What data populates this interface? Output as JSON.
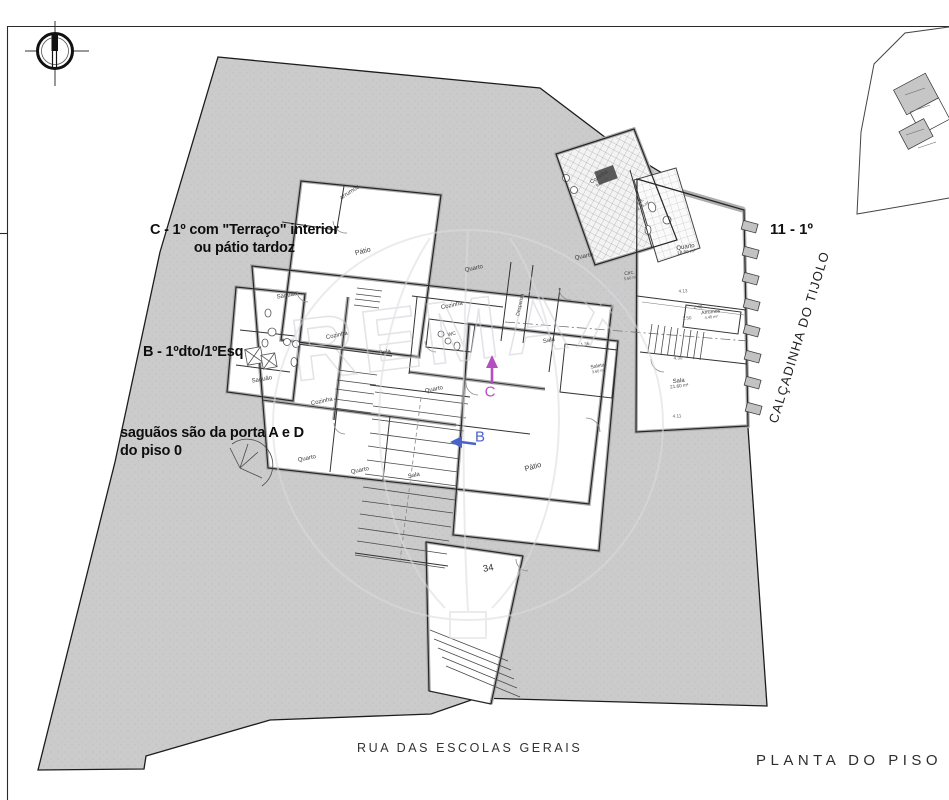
{
  "page": {
    "title": "PLANTA DO PISO 1",
    "street_bottom": "RUA DAS ESCOLAS GERAIS",
    "street_right": "CALÇADINHA DO TIJOLO",
    "unit_note_right": "11 - 1º",
    "house_number": "34"
  },
  "annotations": {
    "unit_c": {
      "line1": "C - 1º com \"Terraço\" interior",
      "line2": "ou pátio tardoz"
    },
    "unit_b": {
      "line1": "B - 1ºdto/1ºEsq"
    },
    "saguaos": {
      "line1": "saguãos são da porta A e D",
      "line2": "do piso 0"
    }
  },
  "markers": {
    "b": "B",
    "c": "C"
  },
  "watermark": {
    "brand": "REMAX"
  },
  "colors": {
    "site_fill": "#cbcbcb",
    "wall_gray": "#aeaeae",
    "ink": "#222222",
    "marker_b_blue": "#4a63c8",
    "marker_c_magenta": "#b44fc0",
    "watermark_gray": "#d6d6da"
  },
  "plan": {
    "rooms": [
      {
        "label": "arrumos",
        "x": 350,
        "y": 193,
        "rot": -33,
        "size": 6
      },
      {
        "label": "Pátio",
        "x": 363,
        "y": 252,
        "rot": -14,
        "size": 7
      },
      {
        "label": "Saguão",
        "x": 287,
        "y": 296,
        "rot": -10,
        "size": 6
      },
      {
        "label": "Cozinha",
        "x": 601,
        "y": 180,
        "rot": -34,
        "size": 5.5,
        "area": "9.60 m²"
      },
      {
        "label": "I.S.",
        "x": 642,
        "y": 204,
        "rot": -34,
        "size": 5,
        "area": "4.15 m²"
      },
      {
        "label": "Quarto",
        "x": 474,
        "y": 269,
        "rot": -12,
        "size": 6
      },
      {
        "label": "Quarto",
        "x": 584,
        "y": 257,
        "rot": -12,
        "size": 6
      },
      {
        "label": "Quarto",
        "x": 686,
        "y": 250,
        "rot": -9,
        "size": 6,
        "area": "18.90 m²"
      },
      {
        "label": "Circ.",
        "x": 630,
        "y": 276,
        "rot": -10,
        "size": 5,
        "area": "5.60 m²"
      },
      {
        "label": "Cozinha",
        "x": 452,
        "y": 306,
        "rot": -12,
        "size": 6
      },
      {
        "label": "Despensa",
        "x": 521,
        "y": 305,
        "rot": -78,
        "size": 5
      },
      {
        "label": "WC",
        "x": 452,
        "y": 335,
        "rot": -12,
        "size": 5
      },
      {
        "label": "Arrumos",
        "x": 711,
        "y": 315,
        "rot": -6,
        "size": 5,
        "area": "4.45 m²"
      },
      {
        "label": "Cozinha",
        "x": 337,
        "y": 336,
        "rot": -12,
        "size": 6
      },
      {
        "label": "Sala",
        "x": 385,
        "y": 353,
        "rot": -12,
        "size": 6
      },
      {
        "label": "Sala",
        "x": 549,
        "y": 341,
        "rot": -12,
        "size": 6
      },
      {
        "label": "Saleta",
        "x": 598,
        "y": 369,
        "rot": -10,
        "size": 5,
        "area": "3.60 m²"
      },
      {
        "label": "Sala",
        "x": 679,
        "y": 384,
        "rot": -7,
        "size": 6,
        "area": "21.60 m²"
      },
      {
        "label": "Saguão",
        "x": 262,
        "y": 380,
        "rot": -10,
        "size": 6
      },
      {
        "label": "Cozinha",
        "x": 322,
        "y": 402,
        "rot": -12,
        "size": 6
      },
      {
        "label": "Quarto",
        "x": 434,
        "y": 390,
        "rot": -12,
        "size": 6
      },
      {
        "label": "Quarto",
        "x": 307,
        "y": 459,
        "rot": -12,
        "size": 6
      },
      {
        "label": "Quarto",
        "x": 360,
        "y": 471,
        "rot": -12,
        "size": 6
      },
      {
        "label": "Sala",
        "x": 414,
        "y": 476,
        "rot": -12,
        "size": 6
      },
      {
        "label": "Pátio",
        "x": 533,
        "y": 467,
        "rot": -16,
        "size": 7.5
      }
    ],
    "dimensions": [
      {
        "t": "4.13",
        "x": 683,
        "y": 291,
        "rot": -4
      },
      {
        "t": "2.48",
        "x": 698,
        "y": 307,
        "rot": -4
      },
      {
        "t": "1.50",
        "x": 687,
        "y": 318,
        "rot": -4
      },
      {
        "t": "4.30",
        "x": 678,
        "y": 358,
        "rot": -4
      },
      {
        "t": "4.11",
        "x": 677,
        "y": 416,
        "rot": -4
      },
      {
        "t": "1.36",
        "x": 585,
        "y": 344,
        "rot": -10
      }
    ]
  }
}
